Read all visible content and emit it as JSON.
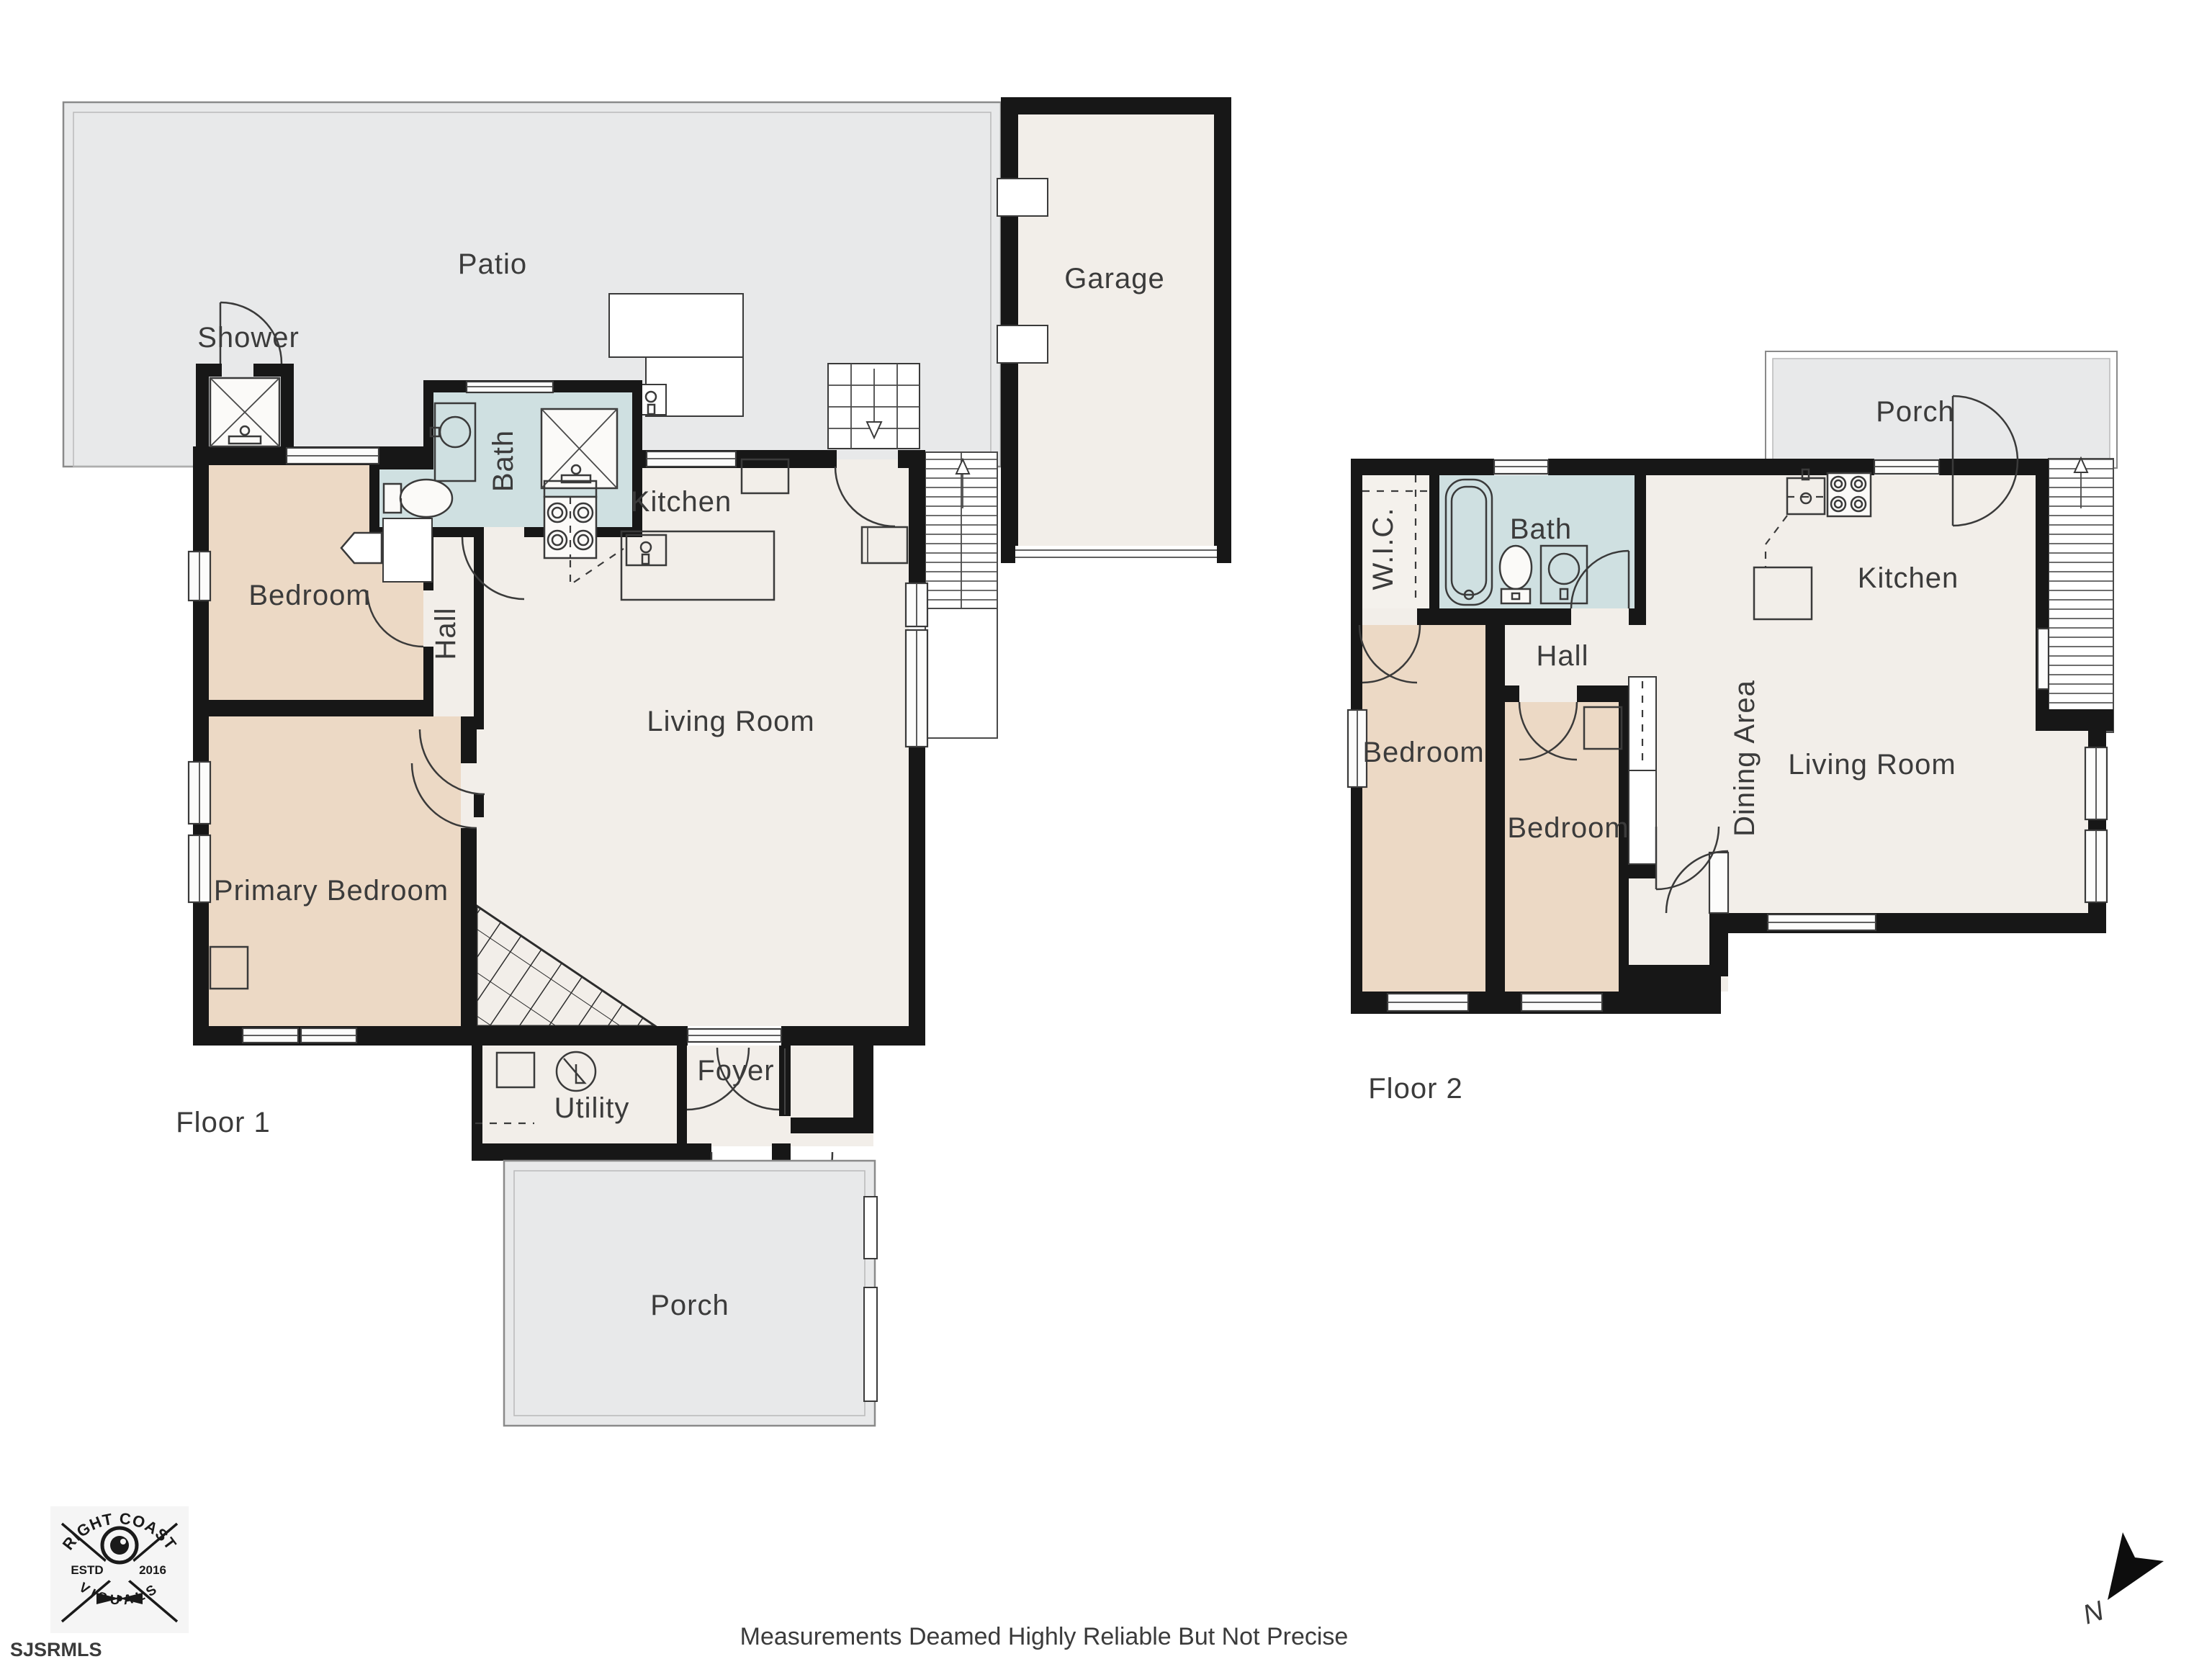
{
  "colors": {
    "wall": "#171717",
    "floor": "#f2eee9",
    "bedroom": "#ecd9c5",
    "bath": "#cfe0e1",
    "outdoor": "#e8e9ea",
    "wic": "#f4f1ec",
    "logo_bg": "#f5f5f5",
    "ink": "#1a1a1a"
  },
  "labels": {
    "f1_patio": "Patio",
    "f1_shower": "Shower",
    "f1_bath": "Bath",
    "f1_kitchen": "Kitchen",
    "f1_bedroom": "Bedroom",
    "f1_hall": "Hall",
    "f1_primary_bedroom": "Primary Bedroom",
    "f1_living_room": "Living Room",
    "f1_utility": "Utility",
    "f1_foyer": "Foyer",
    "f1_porch": "Porch",
    "f1_garage": "Garage",
    "f1_floor": "Floor 1",
    "f2_porch": "Porch",
    "f2_wic": "W.I.C.",
    "f2_bath": "Bath",
    "f2_kitchen": "Kitchen",
    "f2_hall": "Hall",
    "f2_bedroom_left": "Bedroom",
    "f2_bedroom_right": "Bedroom",
    "f2_dining": "Dining Area",
    "f2_living_room": "Living Room",
    "f2_floor": "Floor 2",
    "disclaimer": "Measurements Deamed Highly Reliable But Not Precise",
    "mls": "SJSRMLS",
    "logo_top": "RIGHT COAST",
    "logo_bottom": "VISUALS",
    "logo_estd": "ESTD",
    "logo_year": "2016",
    "compass_n": "N"
  }
}
